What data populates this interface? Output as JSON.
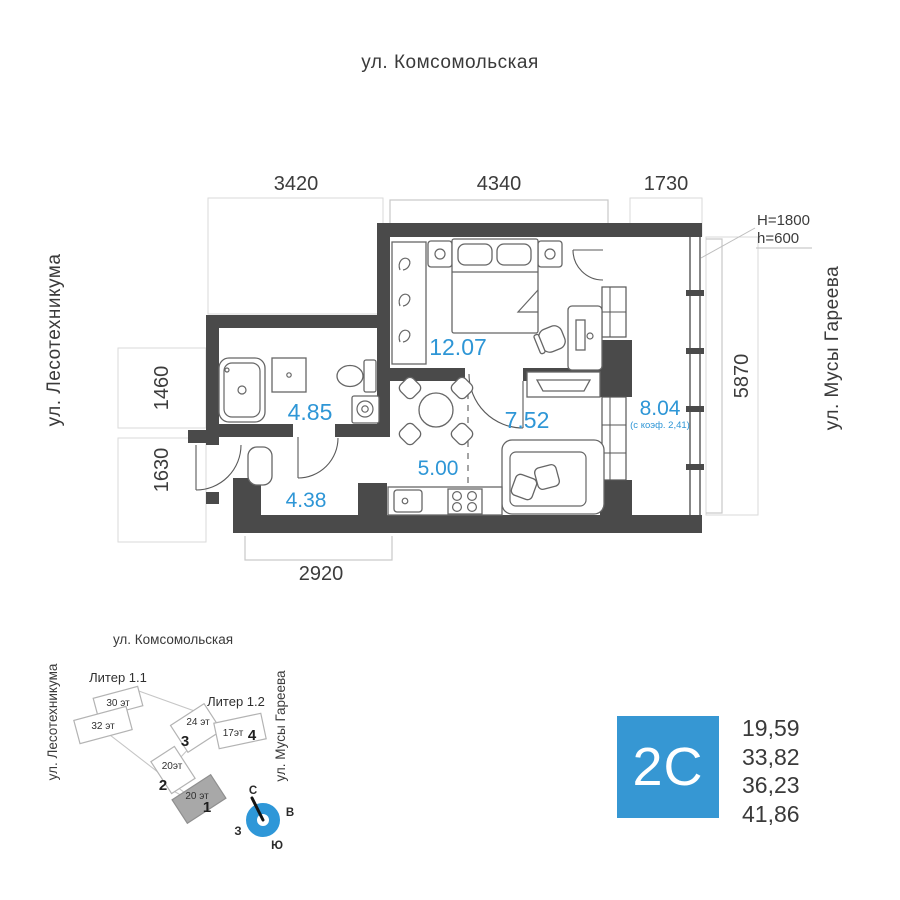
{
  "streets": {
    "top": "ул. Комсомольская",
    "left": "ул. Лесотехникума",
    "right": "ул. Мусы Гареева"
  },
  "plan": {
    "dims": {
      "d3420": "3420",
      "d4340": "4340",
      "d1730": "1730",
      "d1460": "1460",
      "d1630": "1630",
      "d5870": "5870",
      "d2920": "2920"
    },
    "glazing_note": {
      "line1": "H=1800",
      "line2": "h=600"
    },
    "rooms": {
      "bedroom": "12.07",
      "bathroom": "4.85",
      "living": "7.52",
      "loggia": "8.04",
      "loggia_note": "(с коэф. 2,41)",
      "kitchen": "5.00",
      "hall": "4.38"
    }
  },
  "site": {
    "street_top": "ул. Комсомольская",
    "street_left": "ул. Лесотехникума",
    "street_right": "ул. Мусы Гареева",
    "liter1": "Литер 1.1",
    "liter2": "Литер 1.2",
    "b30": "30 эт",
    "b32": "32 эт",
    "b24": "24 эт",
    "n3": "3",
    "b17": "17эт",
    "n4": "4",
    "b20a": "20эт",
    "n2": "2",
    "b20b": "20 эт",
    "n1": "1",
    "compass": {
      "n": "С",
      "e": "В",
      "s": "Ю",
      "w": "З"
    }
  },
  "info": {
    "type": "2С",
    "areas": [
      "19,59",
      "33,82",
      "36,23",
      "41,86"
    ]
  },
  "colors": {
    "accent": "#3697d3",
    "area_text": "#2e96d6",
    "wall": "#4a4a4a"
  }
}
